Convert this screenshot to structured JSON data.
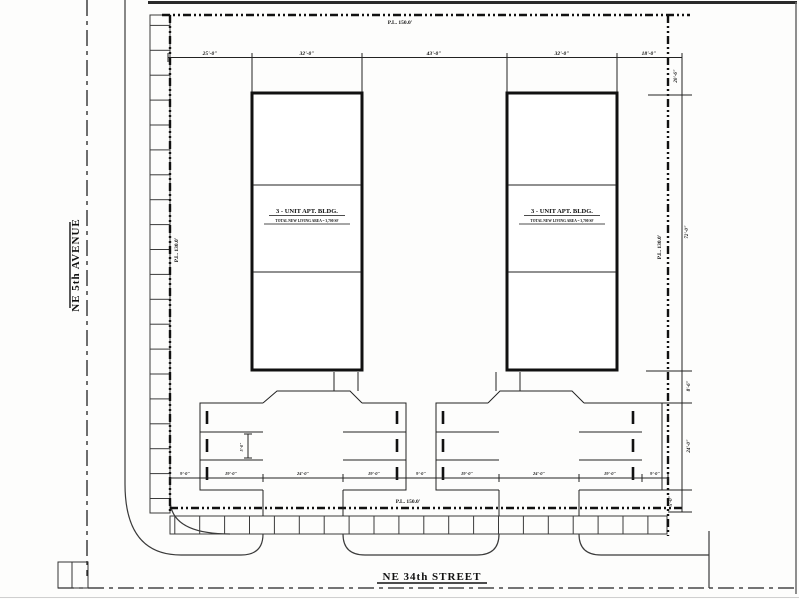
{
  "drawing": {
    "title": "site-plan",
    "streets": {
      "left": "NE 5th AVENUE",
      "bottom": "NE 34th STREET"
    },
    "property_lines": {
      "top": "P.L. 150.0'",
      "bottom": "P.L. 150.0'",
      "left": "P.L. 130.0'",
      "right": "P.L. 130.0'"
    },
    "buildings": [
      {
        "title": "3 - UNIT APT. BLDG.",
        "subtitle": "TOTAL NEW LIVING AREA = 3,700 SF"
      },
      {
        "title": "3 - UNIT APT. BLDG.",
        "subtitle": "TOTAL NEW LIVING AREA = 3,700 SF"
      }
    ],
    "dimensions": {
      "top": [
        "25'-0\"",
        "32'-0\"",
        "43'-0\"",
        "32'-0\"",
        "18'-0\""
      ],
      "right": [
        "20'-6\"",
        "72'-0\"",
        "8'-6\"",
        "24'-0\"",
        "5'-0\""
      ],
      "parking": [
        "9'-0\"",
        "19'-0\"",
        "24'-0\"",
        "19'-0\"",
        "9'-0\"",
        "19'-0\"",
        "24'-0\"",
        "19'-0\"",
        "9'-0\""
      ],
      "stall": "5'-0\""
    },
    "colors": {
      "line": "#1e1e1e",
      "background": "#fdfdfc"
    }
  }
}
